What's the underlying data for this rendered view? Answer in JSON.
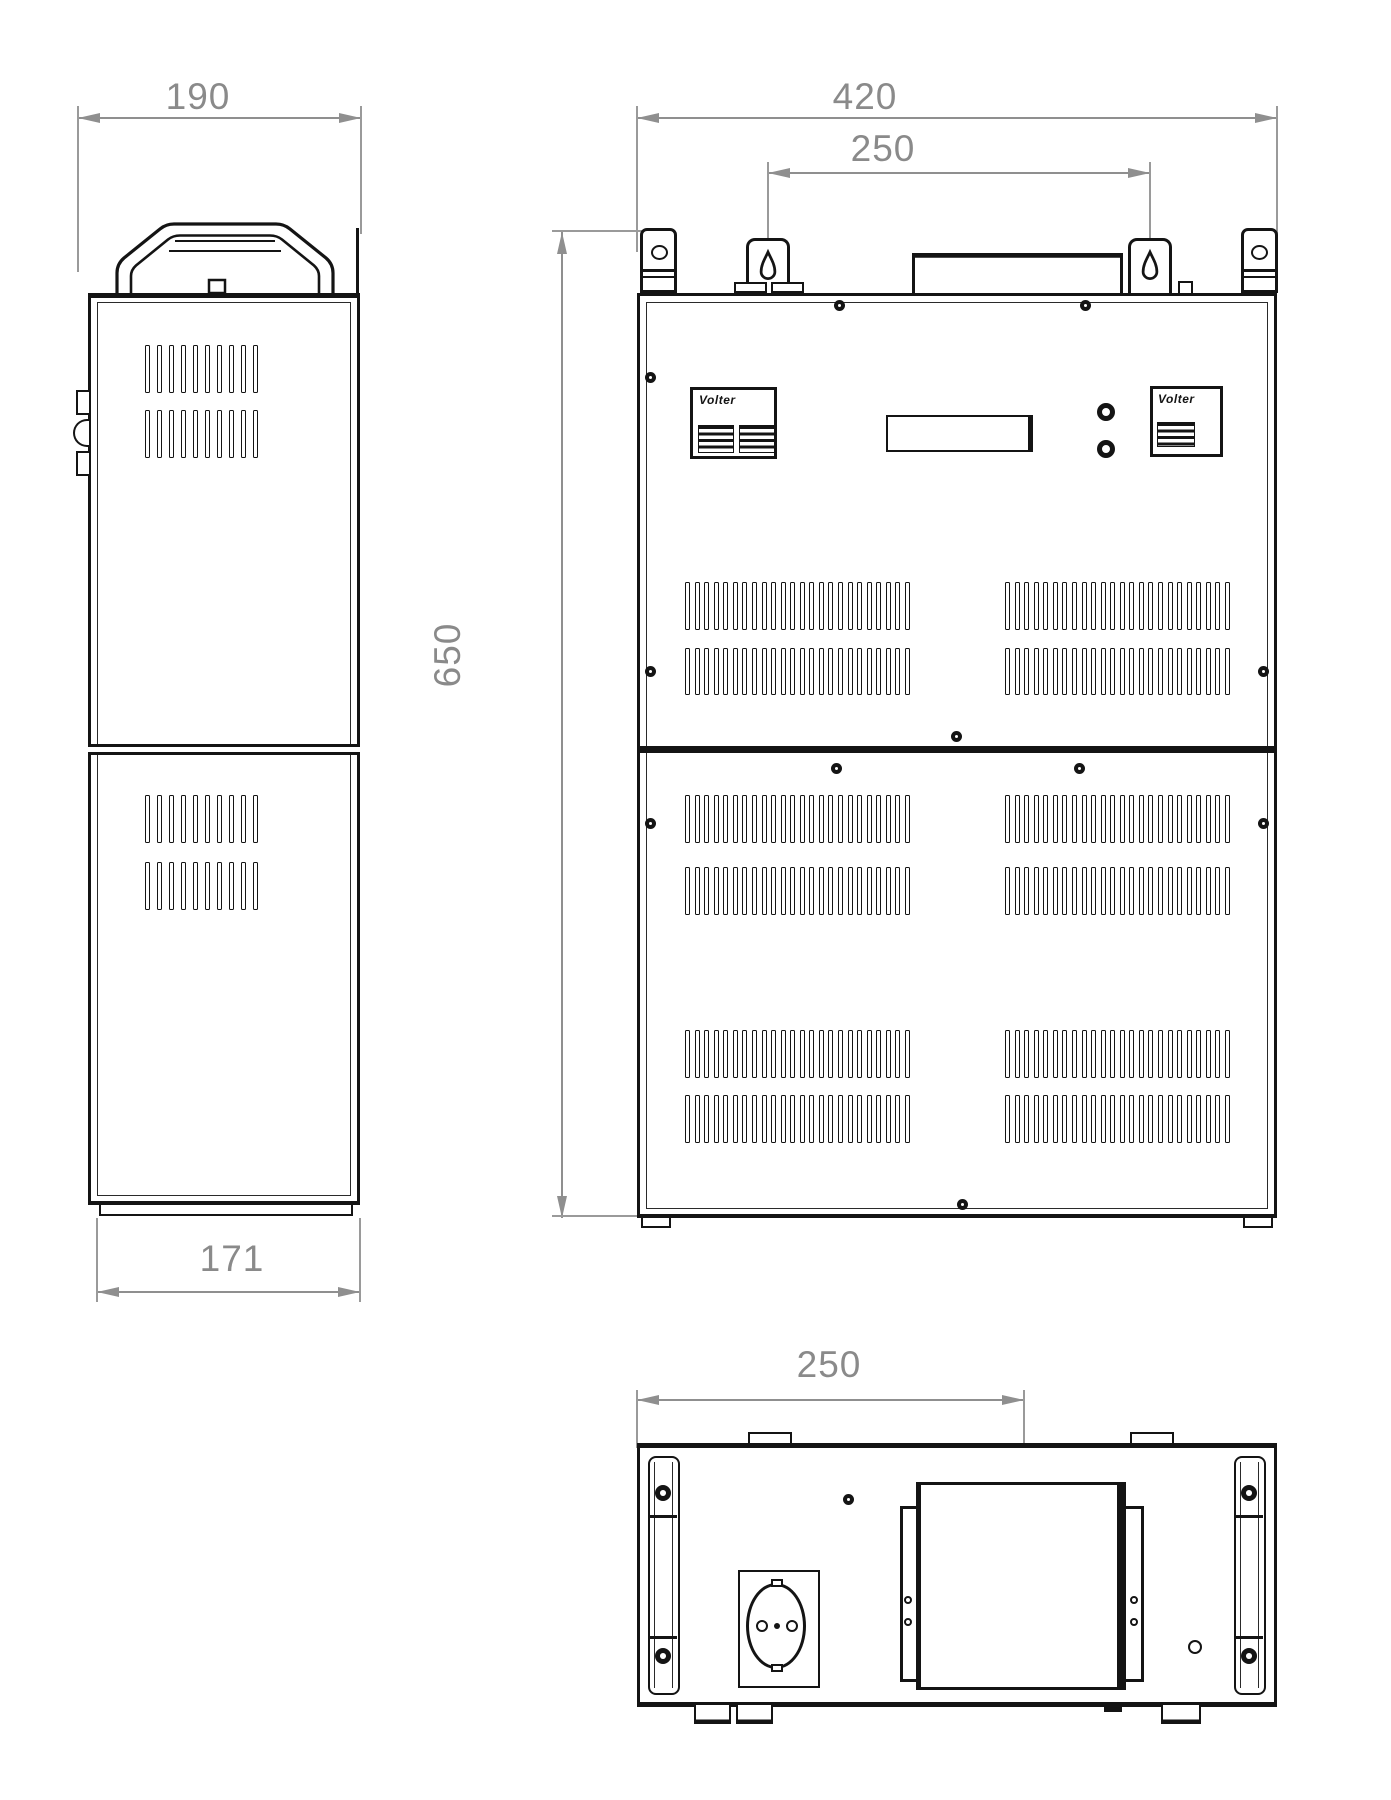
{
  "palette": {
    "background": "#ffffff",
    "line_color": "#141414",
    "dim_color": "#8a8a8a"
  },
  "dimensions": {
    "side_depth_top": "190",
    "side_depth_bottom": "171",
    "front_width": "420",
    "front_keyhole_span": "250",
    "front_height": "650",
    "bottom_socket_offset": "250"
  },
  "branding": {
    "left_panel_logo": "Volter",
    "right_panel_logo": "Volter"
  },
  "vents": {
    "front_slots_per_row": "24",
    "side_slots_per_row": "10"
  },
  "views": {
    "left": "side-view",
    "center": "front-view",
    "bottom": "bottom-view"
  }
}
